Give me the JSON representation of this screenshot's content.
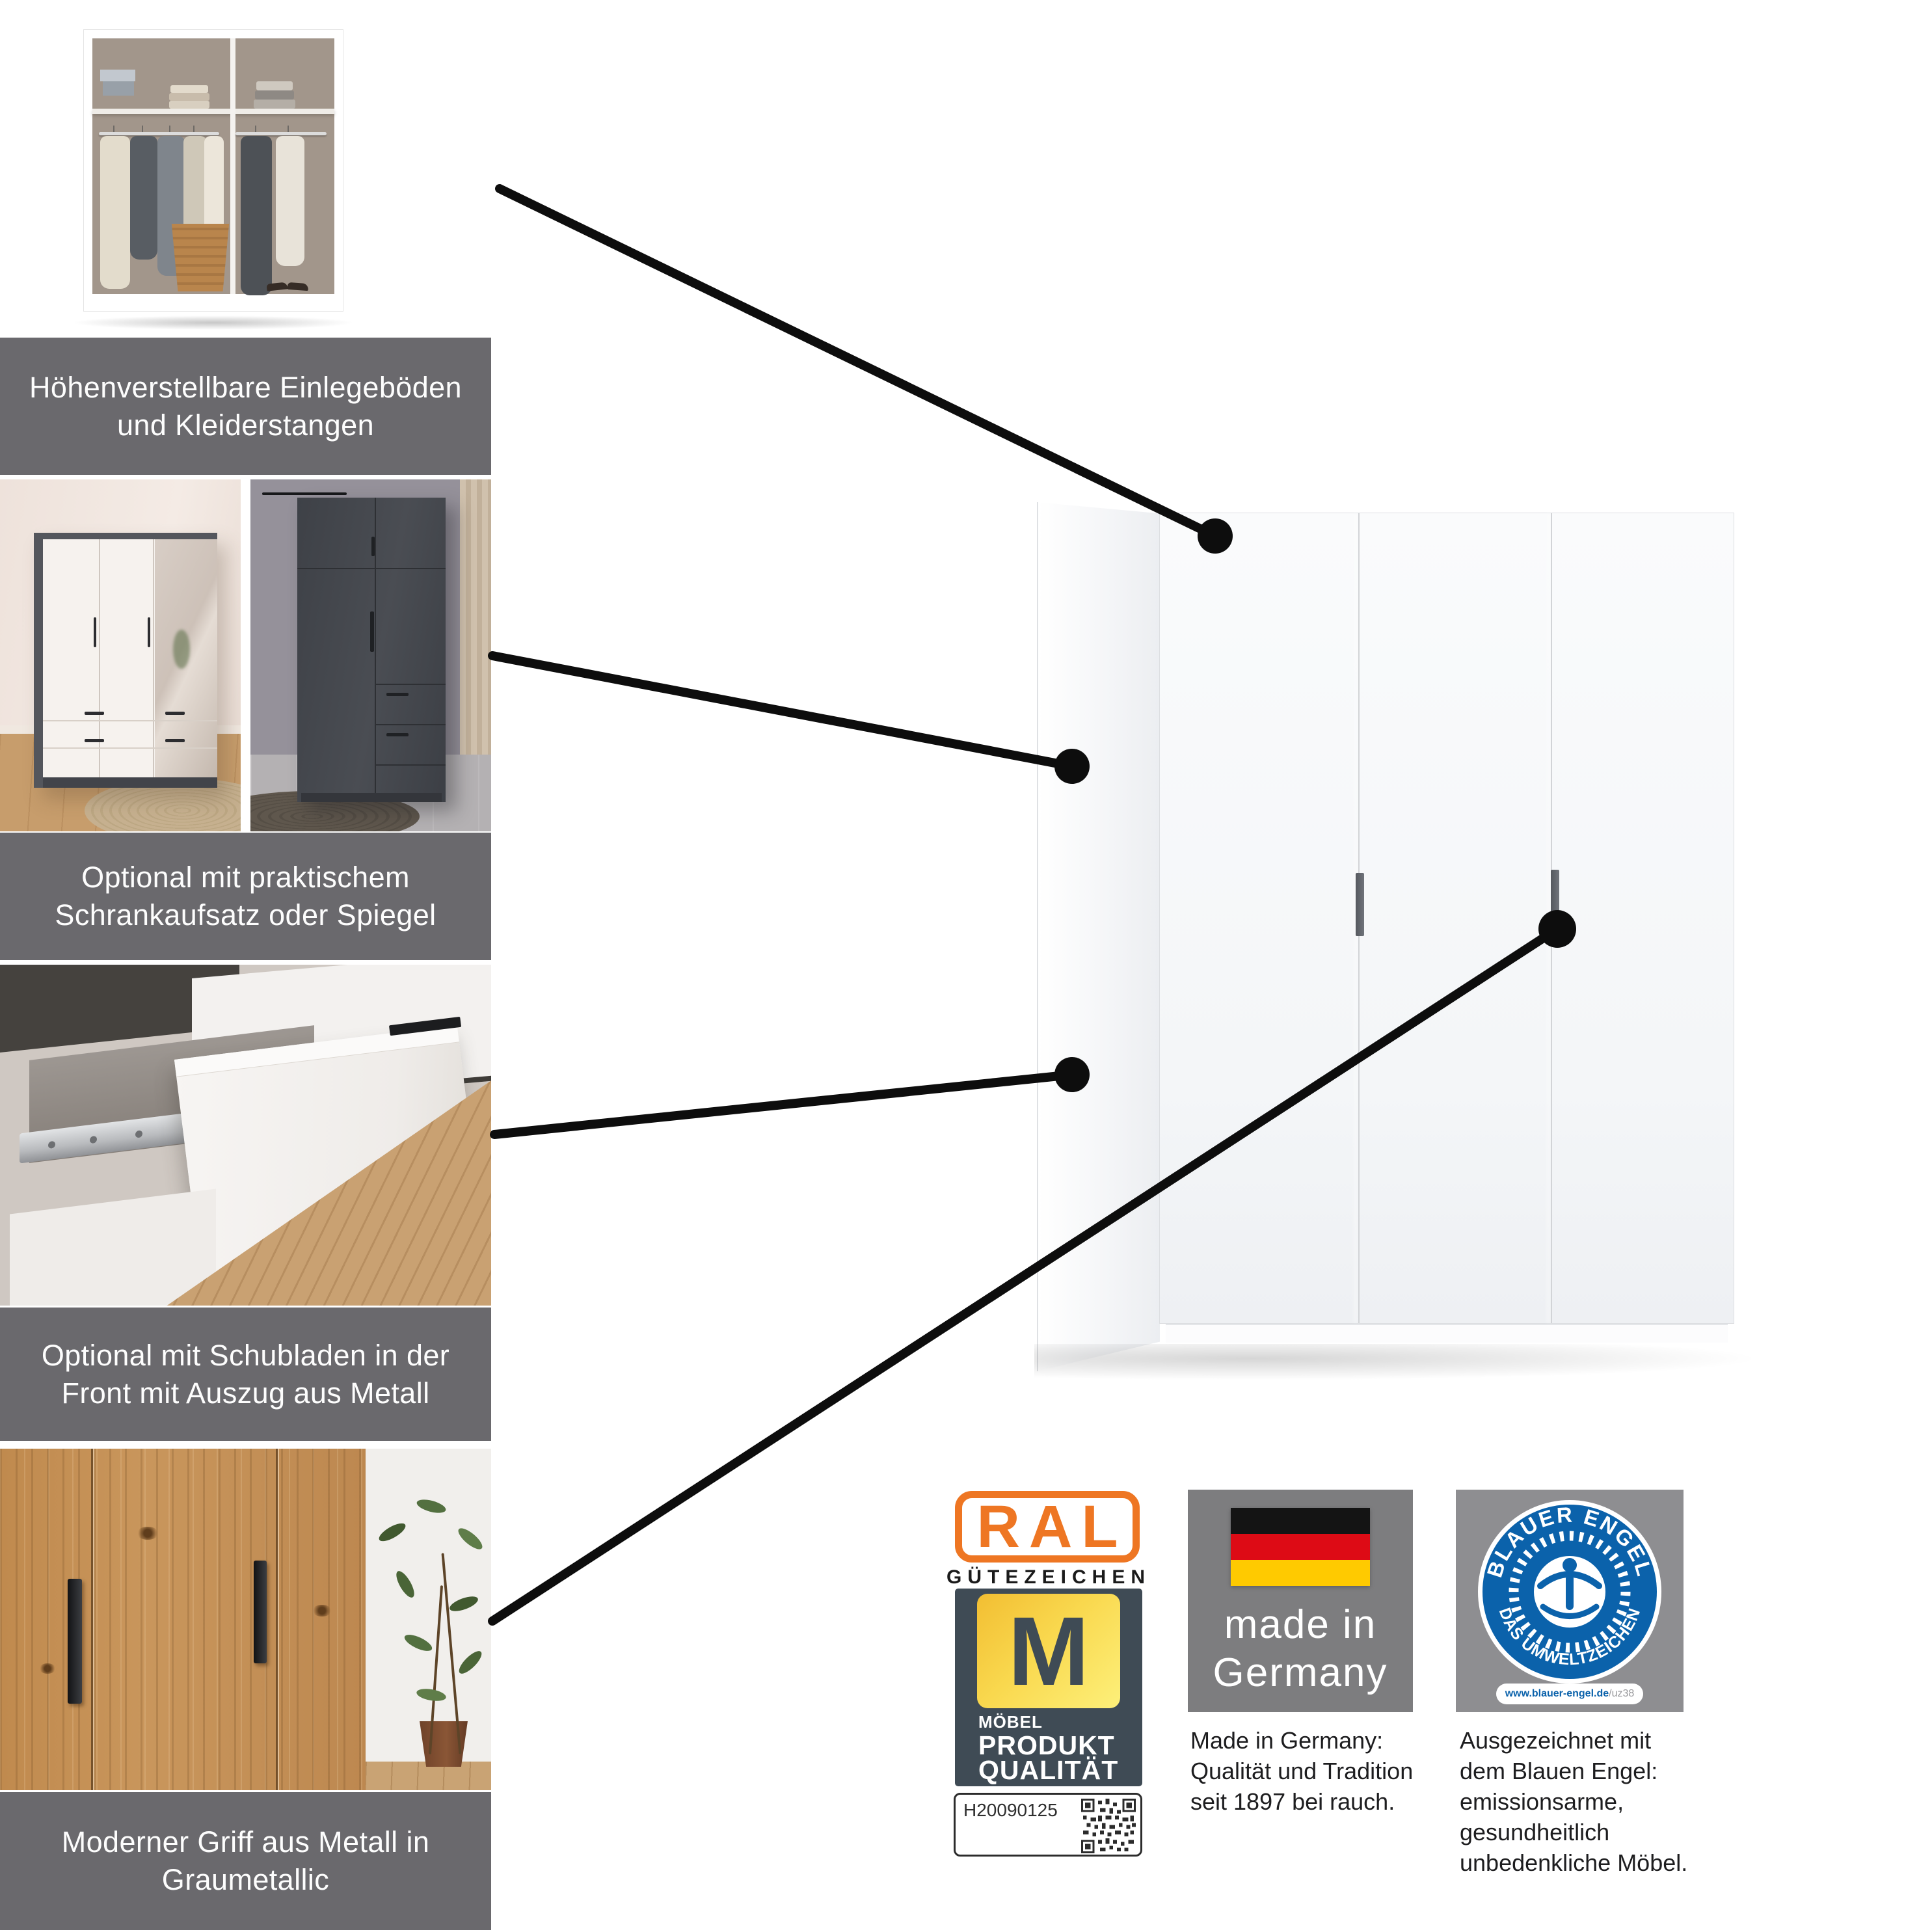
{
  "features": [
    {
      "caption_line1": "Höhenverstellbare Einlegeböden",
      "caption_line2": "und Kleiderstangen",
      "image": "wardrobe-interior-with-shelves-and-rails"
    },
    {
      "caption_line1": "Optional mit praktischem",
      "caption_line2": "Schrankaufsatz oder Spiegel",
      "image": "white-wardrobe-with-mirror-and-grey-wardrobe-with-top-unit"
    },
    {
      "caption_line1": "Optional mit Schubladen in der",
      "caption_line2": "Front mit Auszug aus Metall",
      "image": "open-drawer-with-metal-runner"
    },
    {
      "caption_line1": "Moderner Griff aus Metall in",
      "caption_line2": "Graumetallic",
      "image": "wood-doors-with-metal-handles"
    }
  ],
  "badges": {
    "ral": {
      "logo": "RAL",
      "subtitle": "GÜTEZEICHEN",
      "m_letter": "M",
      "line_small": "MÖBEL",
      "line_big1": "PRODUKT",
      "line_big2": "QUALITÄT",
      "code": "H20090125",
      "orange": "#ee7623",
      "slate": "#3f4b55",
      "yellow": "#f9d84e"
    },
    "made_in": {
      "line1": "made in",
      "line2": "Germany",
      "flag": "german-flag",
      "text": [
        "Made in Germany:",
        "Qualität und Tradition",
        "seit 1897 bei rauch."
      ],
      "box_grey": "#7d7d7f"
    },
    "blauer_engel": {
      "arc_top": "BLAUER ENGEL",
      "arc_bottom": "DAS UMWELTZEICHEN",
      "url_bold": "www.blauer-engel.de",
      "url_suffix": "/uz38",
      "text": [
        "Ausgezeichnet mit",
        "dem Blauen Engel:",
        "emissionsarme,",
        "gesundheitlich",
        "unbedenkliche Möbel."
      ],
      "blue": "#0b62ab",
      "box_grey": "#8e8e91"
    }
  },
  "colors": {
    "caption_band": "#6a696d",
    "callout": "#0d0d0d",
    "background": "#ffffff"
  }
}
